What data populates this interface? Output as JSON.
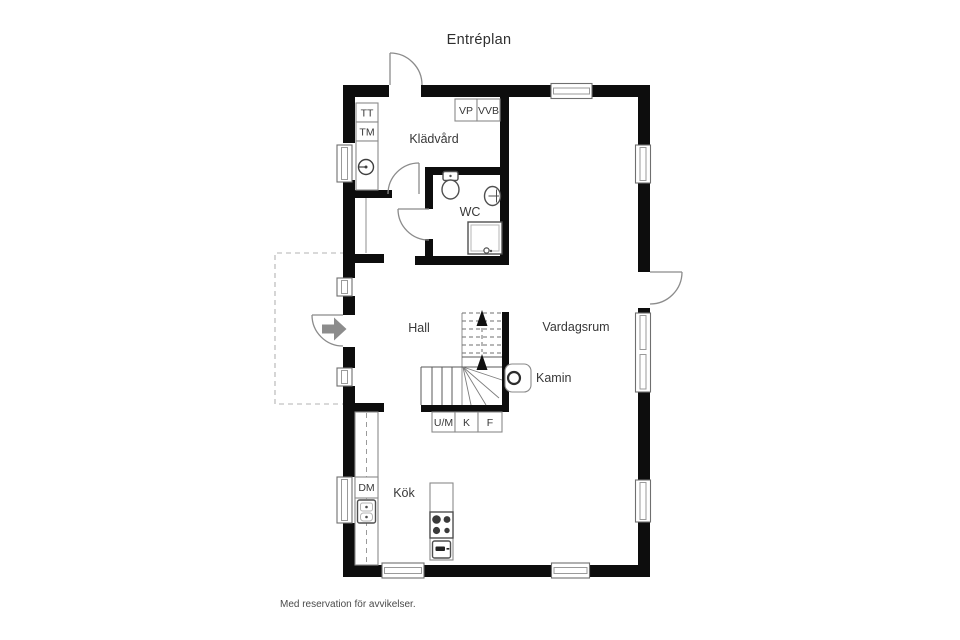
{
  "title": "Entréplan",
  "footer": {
    "disclaimer": "Med reservation för avvikelser."
  },
  "plan": {
    "rooms": [
      {
        "id": "kladvard",
        "label": "Klädvård"
      },
      {
        "id": "wc",
        "label": "WC"
      },
      {
        "id": "hall",
        "label": "Hall"
      },
      {
        "id": "vardagsrum",
        "label": "Vardagsrum"
      },
      {
        "id": "kok",
        "label": "Kök"
      }
    ],
    "features": [
      {
        "id": "kamin",
        "label": "Kamin"
      }
    ],
    "appliances": [
      {
        "id": "tt",
        "label": "TT"
      },
      {
        "id": "tm",
        "label": "TM"
      },
      {
        "id": "vp",
        "label": "VP"
      },
      {
        "id": "vvb",
        "label": "VVB"
      },
      {
        "id": "dm",
        "label": "DM"
      },
      {
        "id": "um",
        "label": "U/M"
      },
      {
        "id": "k",
        "label": "K"
      },
      {
        "id": "f",
        "label": "F"
      }
    ],
    "colors": {
      "wall": "#0d0d0d",
      "label_text": "#383838",
      "title_text": "#2f2f2f",
      "fixture_outline": "#4f4f4f",
      "light_outline": "#8a8a8a",
      "window_outline": "#6f6f6f",
      "window_inner": "#9a9a9a",
      "door_stroke": "#8b8b8b",
      "arrow_fill": "#8c8c8c",
      "dashed_outline": "#b3b3b3",
      "burner_fill": "#3a3a3a",
      "disclaimer_text": "#4a4a4a"
    }
  }
}
